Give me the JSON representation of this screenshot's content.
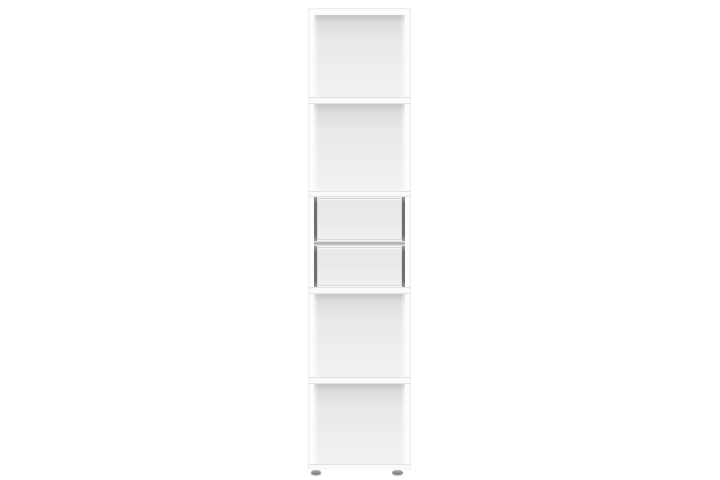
{
  "meta": {
    "description": "Product photo of a tall narrow white bookcase standing on a plain white background"
  },
  "bookcase": {
    "label": "Tall white bookcase with four open compartments and two drawers",
    "sections": [
      {
        "id": "open-compartment-1",
        "kind": "open shelf compartment",
        "position": "top"
      },
      {
        "id": "open-compartment-2",
        "kind": "open shelf compartment",
        "position": "upper-middle"
      },
      {
        "id": "drawer-1",
        "kind": "drawer",
        "position": "middle"
      },
      {
        "id": "drawer-2",
        "kind": "drawer",
        "position": "middle"
      },
      {
        "id": "open-compartment-3",
        "kind": "open shelf compartment",
        "position": "lower-middle"
      },
      {
        "id": "open-compartment-4",
        "kind": "open shelf compartment",
        "position": "bottom"
      }
    ],
    "shelf_count": 4,
    "drawer_count": 2,
    "feet_count": 2
  },
  "colors": {
    "background": "#ffffff",
    "case_face": "#fcfcfc",
    "case_edge": "#eeeeee",
    "shelf_face": "#fafafa",
    "shelf_edge": "#e3e3e3",
    "interior_dark": "#d6d6d6",
    "interior_mid": "#e9e9e9",
    "interior_light": "#f2f2f2",
    "drawer_front": "#e7e7e7",
    "drawer_front_light": "#f0f0f0",
    "drawer_edge": "#d8d8d8",
    "drawer_gap": "#6f6f6f",
    "drawer_divider": "#a8a8a8",
    "foot_dark": "#7d7d7d",
    "foot_light": "#b8b8b8"
  }
}
